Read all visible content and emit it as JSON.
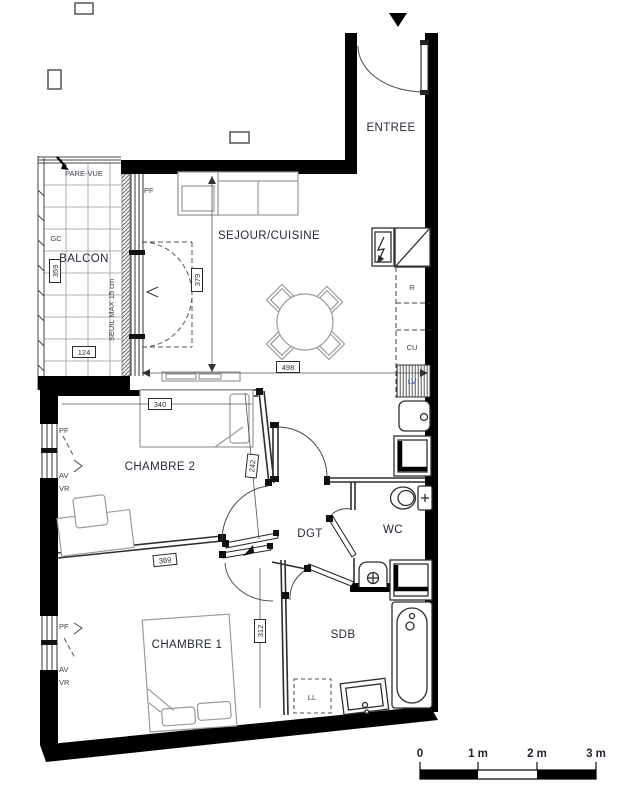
{
  "plan": {
    "rooms": {
      "entree": "ENTREE",
      "sejour_cuisine": "SEJOUR/CUISINE",
      "balcon": "BALCON",
      "chambre2": "CHAMBRE 2",
      "chambre1": "CHAMBRE 1",
      "dgt": "DGT",
      "wc": "WC",
      "sdb": "SDB"
    },
    "dimensions_cm": {
      "sejour_height": "379",
      "sejour_width": "498",
      "chambre2_width": "340",
      "chambre2_depth": "242",
      "chambre2_diag": "369",
      "chambre1_height": "312",
      "balcon_height": "359",
      "balcon_width": "124"
    },
    "window_labels": {
      "pf": "PF",
      "av": "AV",
      "vr": "VR"
    },
    "annotations": {
      "pare_vue": "PARE-VUE",
      "gc": "GC",
      "seuil": "SEUIL MAX 15 cm"
    },
    "appliances": {
      "r": "R",
      "cu": "CU",
      "lv": "LV",
      "ll": "LL"
    },
    "scale_bar": {
      "labels": [
        "0",
        "1 m",
        "2 m",
        "3 m"
      ]
    },
    "colors": {
      "wall": "#000000",
      "room_label": "#252a38",
      "small_label": "#3a4152",
      "furniture_line": "#9a9a9a",
      "fixture_line": "#2e2e2e",
      "lv_label": "#3d4fae"
    }
  }
}
